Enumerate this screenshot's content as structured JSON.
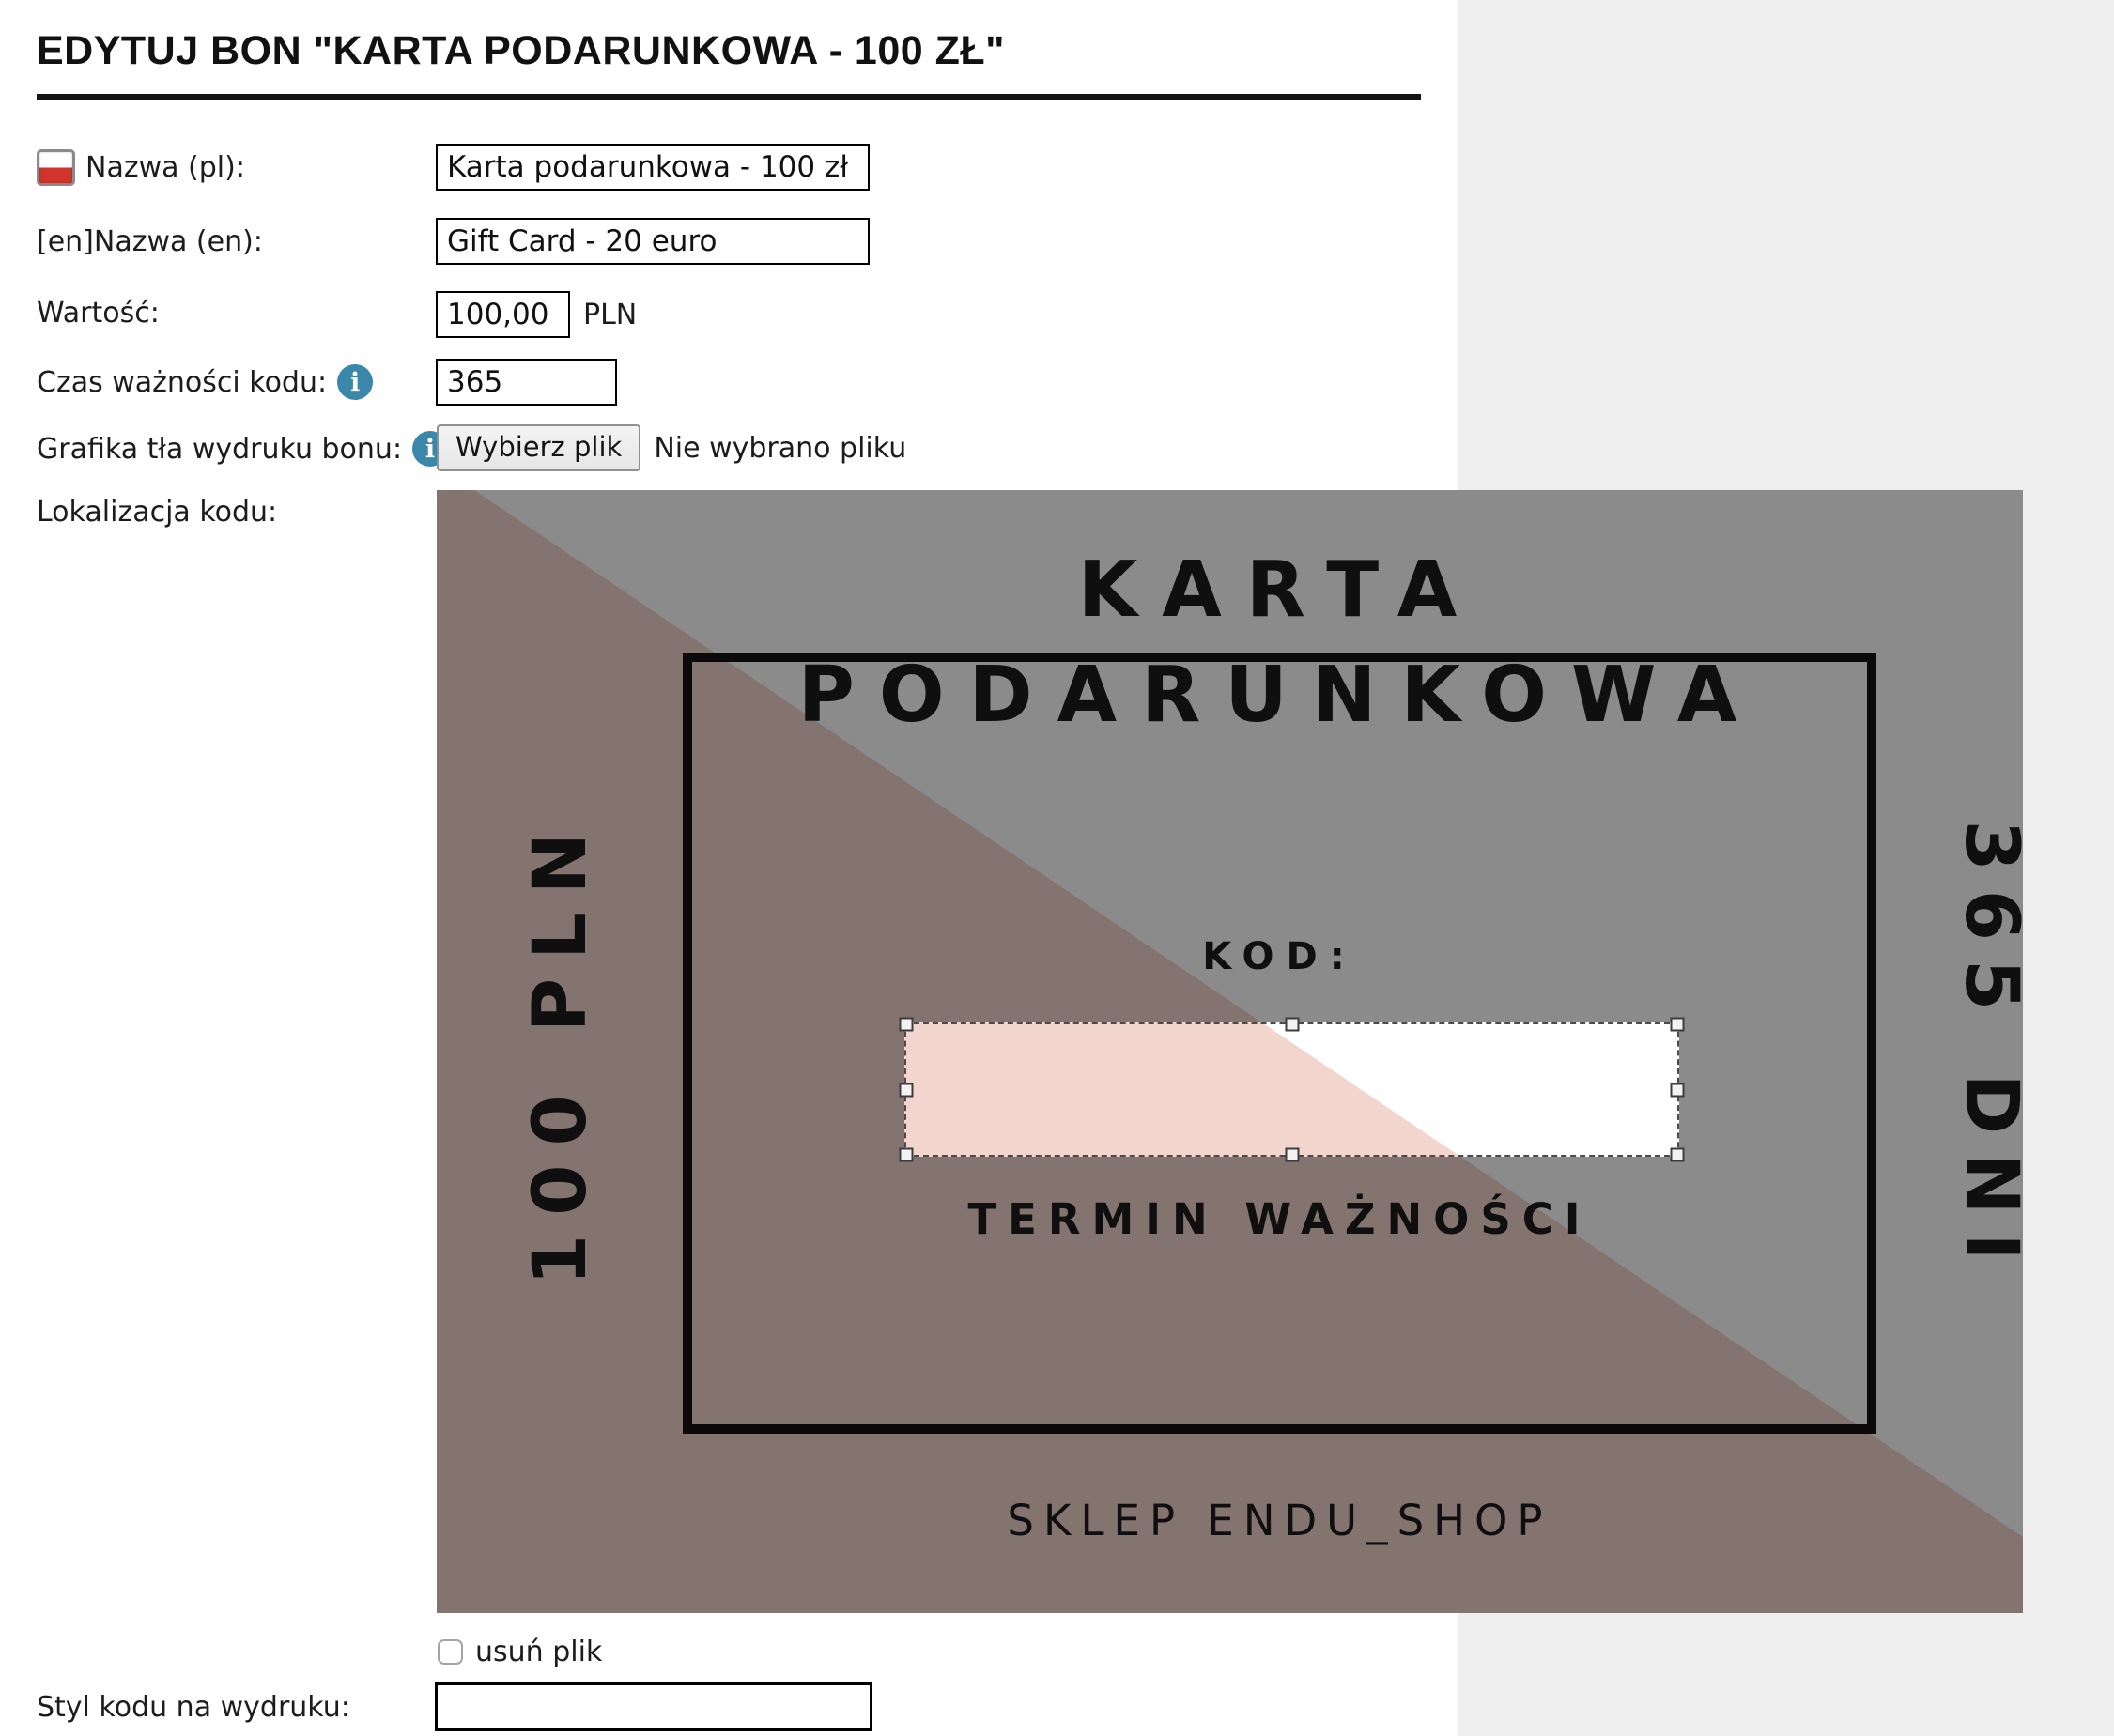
{
  "page": {
    "title": "EDYTUJ BON \"KARTA PODARUNKOWA - 100 ZŁ\""
  },
  "form": {
    "name_pl": {
      "label": "Nazwa (pl):",
      "value": "Karta podarunkowa - 100 zł"
    },
    "name_en": {
      "label": "[en]Nazwa (en):",
      "value": "Gift Card - 20 euro"
    },
    "value": {
      "label": "Wartość:",
      "value": "100,00",
      "unit": "PLN"
    },
    "validity": {
      "label": "Czas ważności kodu:",
      "value": "365"
    },
    "background_graphic": {
      "label": "Grafika tła wydruku bonu:",
      "button_label": "Wybierz plik",
      "status": "Nie wybrano pliku"
    },
    "code_location": {
      "label": "Lokalizacja kodu:"
    },
    "remove_file": {
      "label": "usuń plik",
      "checked": false
    },
    "code_style": {
      "label": "Styl kodu na wydruku:",
      "value": ""
    }
  },
  "card": {
    "title_line1": "KARTA",
    "title_line2": "PODARUNKOWA",
    "left_vertical_text": "100 PLN",
    "right_vertical_text": "365 DNI",
    "code_caption": "KOD:",
    "validity_caption": "TERMIN WAŻNOŚCI",
    "footer_caption": "SKLEP ENDU_SHOP",
    "colors": {
      "base_background": "#ffffff",
      "accent_triangle": "#f2d5cd",
      "dim_overlay": "rgba(0,0,0,0.455)",
      "ink": "#1c1c1c"
    }
  },
  "icons": {
    "info_glyph": "i"
  },
  "colors": {
    "info_icon": "#3b87a9",
    "flag_red": "#d0342c",
    "flag_white": "#ffffff",
    "side_panel": "#efefef",
    "title_ink": "#111111"
  }
}
